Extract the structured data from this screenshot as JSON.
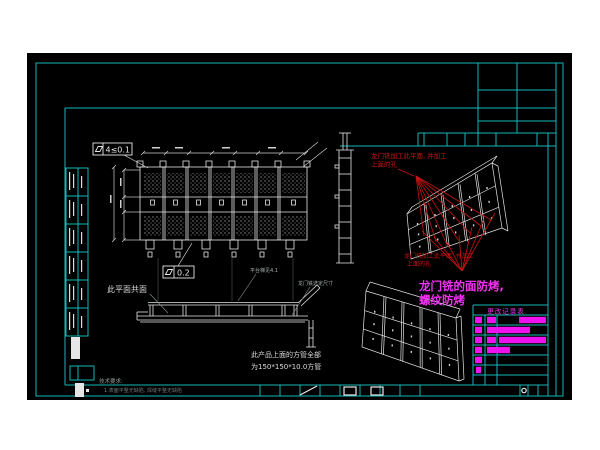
{
  "page": {
    "background": "#ffffff"
  },
  "cad": {
    "colors": {
      "canvas": "#000000",
      "frame_cyan": "#14b8b8",
      "line_white": "#e6e6e6",
      "annotation_red": "#c81414",
      "highlight_magenta": "#f332f3",
      "dim_gray": "#97a0a0"
    },
    "gdt": {
      "flatness_top": "4≤0.1",
      "flatness_mid": "0.2"
    },
    "labels": {
      "coplanar": "此平面共面",
      "platform": "平台梯见4.1",
      "gantry_dim": "龙门铣选定尺寸",
      "tube_note_line1": "此产品上面的方管全部",
      "tube_note_line2": "为150*150*10.0方管",
      "tech_req_title": "技术要求:",
      "tech_req_item": "1.表面平整无缺陷, 焊缝平整无缺陷"
    },
    "red_notes": {
      "top_line1": "龙门铣加工此平面, 并加工",
      "top_line2": "上面的孔",
      "bottom_line1": "龙门铣加工此平面, 并加工",
      "bottom_line2": "上面的孔"
    },
    "magenta_note": {
      "line1": "龙门铣的面防烤,",
      "line2": "螺纹防烤"
    },
    "revision_table": {
      "header": "更改记录表",
      "x": 473,
      "y": 305,
      "right": 548,
      "row_height": 10,
      "row_count": 8,
      "columns": [
        473,
        485,
        497,
        548
      ],
      "rows": [
        [
          [
            475,
            7
          ],
          [
            487,
            9
          ],
          [
            519,
            27
          ]
        ],
        [
          [
            475,
            7
          ],
          [
            487,
            43
          ]
        ],
        [
          [
            475,
            7
          ],
          [
            487,
            9
          ],
          [
            499,
            47
          ]
        ],
        [
          [
            475,
            7
          ],
          [
            487,
            23
          ]
        ],
        [
          [
            475,
            7
          ]
        ],
        [
          [
            476,
            5
          ]
        ],
        []
      ]
    },
    "part_strip": {
      "x": 66,
      "y": 168,
      "rows": 6,
      "row_height": 28,
      "col_widths": [
        12,
        10
      ]
    }
  }
}
